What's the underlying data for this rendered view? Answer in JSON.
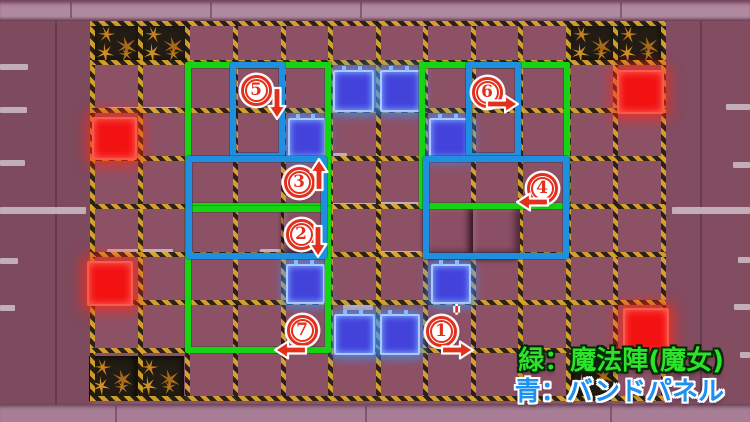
{
  "legend": {
    "green_label": "緑：魔法陣(魔女)",
    "blue_label": "青：バンドパネル"
  },
  "colors": {
    "floor": "#8d5166",
    "hazard_yellow": "#d9a72b",
    "hazard_black": "#241d13",
    "magic_circle_green": "#14d414",
    "band_outline_blue": "#1f8fe0",
    "band_panel_blue": "#4343dc",
    "panel_red": "#f31212",
    "marker_red": "#e2301c",
    "legend_green": "#2be32b",
    "legend_blue": "#1e90f0"
  },
  "board": {
    "grid": {
      "v_x": [
        92,
        140,
        187,
        235,
        283,
        330,
        378,
        425,
        473,
        520,
        568,
        615,
        663
      ],
      "h_y": [
        23,
        62,
        110,
        158,
        206,
        254,
        302,
        350,
        398
      ],
      "y_top": 21,
      "y_bottom": 401,
      "x_left": 90,
      "x_right": 666
    },
    "damaged_tiles": [
      {
        "x": 93,
        "y": 23,
        "w": 47,
        "h": 39
      },
      {
        "x": 140,
        "y": 23,
        "w": 48,
        "h": 39
      },
      {
        "x": 568,
        "y": 23,
        "w": 47,
        "h": 39
      },
      {
        "x": 615,
        "y": 23,
        "w": 48,
        "h": 39
      },
      {
        "x": 89,
        "y": 356,
        "w": 47,
        "h": 45
      },
      {
        "x": 136,
        "y": 356,
        "w": 48,
        "h": 45
      },
      {
        "x": 570,
        "y": 353,
        "w": 46,
        "h": 46
      }
    ],
    "raised_tiles": [
      {
        "x": 284,
        "y": 207,
        "w": 46,
        "h": 46
      },
      {
        "x": 426,
        "y": 207,
        "w": 47,
        "h": 51
      },
      {
        "x": 473,
        "y": 207,
        "w": 47,
        "h": 51
      }
    ],
    "highlight_dashes": [
      [
        0,
        64,
        28,
        6
      ],
      [
        0,
        107,
        27,
        6
      ],
      [
        0,
        160,
        25,
        6
      ],
      [
        0,
        207,
        86,
        7
      ],
      [
        0,
        258,
        18,
        6
      ],
      [
        0,
        305,
        15,
        6
      ],
      [
        108,
        107,
        70,
        6
      ],
      [
        672,
        207,
        78,
        7
      ],
      [
        726,
        104,
        24,
        6
      ],
      [
        733,
        162,
        17,
        6
      ],
      [
        738,
        257,
        12,
        6
      ],
      [
        734,
        304,
        16,
        6
      ],
      [
        740,
        352,
        10,
        6
      ],
      [
        333,
        104,
        38,
        6
      ],
      [
        380,
        104,
        38,
        6
      ],
      [
        287,
        154,
        36,
        5
      ],
      [
        430,
        152,
        38,
        5
      ],
      [
        333,
        153,
        14,
        5
      ],
      [
        332,
        203,
        44,
        6
      ],
      [
        378,
        202,
        44,
        6
      ],
      [
        260,
        249,
        60,
        6
      ],
      [
        375,
        251,
        46,
        6
      ],
      [
        107,
        249,
        66,
        6
      ],
      [
        343,
        305,
        30,
        5
      ],
      [
        283,
        299,
        38,
        5
      ]
    ],
    "red_panels": [
      {
        "x": 92,
        "y": 117,
        "w": 41,
        "h": 39
      },
      {
        "x": 87,
        "y": 261,
        "w": 42,
        "h": 41
      },
      {
        "x": 617,
        "y": 70,
        "w": 43,
        "h": 40
      },
      {
        "x": 623,
        "y": 308,
        "w": 42,
        "h": 42
      }
    ],
    "blue_panels": [
      {
        "x": 288,
        "y": 118,
        "w": 34,
        "h": 36
      },
      {
        "x": 333,
        "y": 70,
        "w": 37,
        "h": 38
      },
      {
        "x": 380,
        "y": 70,
        "w": 37,
        "h": 38
      },
      {
        "x": 429,
        "y": 118,
        "w": 37,
        "h": 37
      },
      {
        "x": 286,
        "y": 264,
        "w": 35,
        "h": 36
      },
      {
        "x": 431,
        "y": 264,
        "w": 36,
        "h": 36
      },
      {
        "x": 334,
        "y": 314,
        "w": 37,
        "h": 37
      },
      {
        "x": 380,
        "y": 314,
        "w": 36,
        "h": 37
      }
    ]
  },
  "annotations": {
    "magic_circles": [
      {
        "x": 185,
        "y": 62,
        "w": 146,
        "h": 147
      },
      {
        "x": 185,
        "y": 206,
        "w": 146,
        "h": 147
      },
      {
        "x": 419,
        "y": 62,
        "w": 151,
        "h": 147
      }
    ],
    "band_outlines": [
      {
        "x": 230,
        "y": 62,
        "w": 55,
        "h": 97
      },
      {
        "x": 186,
        "y": 156,
        "w": 141,
        "h": 103
      },
      {
        "x": 466,
        "y": 62,
        "w": 55,
        "h": 97
      },
      {
        "x": 423,
        "y": 156,
        "w": 146,
        "h": 103
      }
    ],
    "markers": [
      {
        "label": "1",
        "prime": "'",
        "cx": 441,
        "cy": 331,
        "arrow": {
          "dir": "right",
          "cx": 457,
          "cy": 350
        }
      },
      {
        "label": "2",
        "prime": "",
        "cx": 301,
        "cy": 234,
        "arrow": {
          "dir": "down",
          "cx": 318,
          "cy": 241
        }
      },
      {
        "label": "3",
        "prime": "",
        "cx": 299,
        "cy": 182,
        "arrow": {
          "dir": "up",
          "cx": 319,
          "cy": 175
        }
      },
      {
        "label": "4",
        "prime": "",
        "cx": 542,
        "cy": 188,
        "arrow": {
          "dir": "left",
          "cx": 533,
          "cy": 202
        }
      },
      {
        "label": "5",
        "prime": "",
        "cx": 256,
        "cy": 90,
        "arrow": {
          "dir": "down",
          "cx": 277,
          "cy": 103
        }
      },
      {
        "label": "6",
        "prime": "",
        "cx": 487,
        "cy": 92,
        "arrow": {
          "dir": "right",
          "cx": 502,
          "cy": 104
        }
      },
      {
        "label": "7",
        "prime": "",
        "cx": 302,
        "cy": 330,
        "arrow": {
          "dir": "left",
          "cx": 291,
          "cy": 350
        }
      }
    ]
  }
}
